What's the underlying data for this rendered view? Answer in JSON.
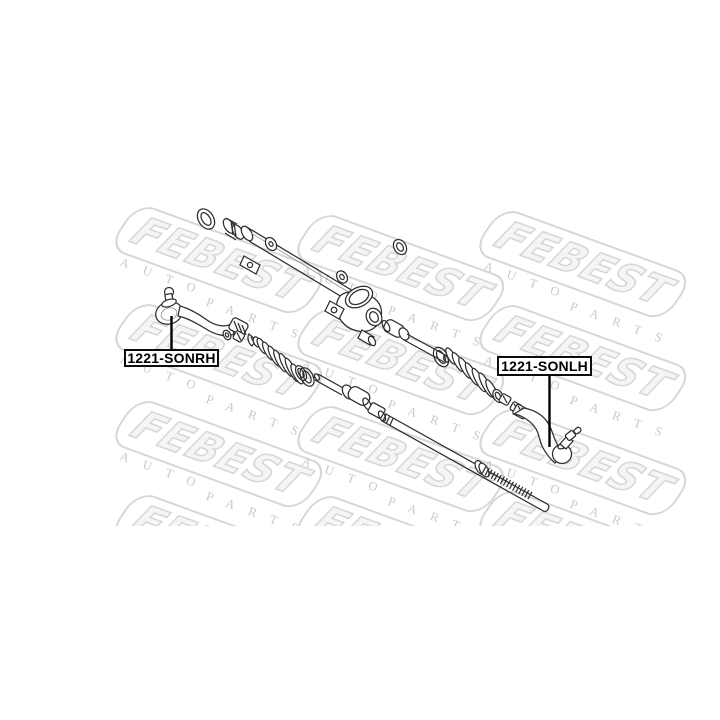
{
  "page": {
    "width": 720,
    "height": 720,
    "background": "#ffffff"
  },
  "theme": {
    "line_color": "#2e2e2e",
    "label_border_color": "#0d0d0d",
    "label_text_color": "#000000",
    "watermark_outline": "#d7d7d7",
    "watermark_fill": "#f5f5f5",
    "watermark_serif": "#c9c9c9",
    "page_bg": "#ffffff"
  },
  "watermark": {
    "brand": "FEBEST",
    "word_top": "AUTO",
    "word_bottom": "PARTS",
    "instances": [
      {
        "x": 138,
        "y": 6
      },
      {
        "x": 320,
        "y": 14
      },
      {
        "x": 502,
        "y": 10
      },
      {
        "x": 138,
        "y": 103
      },
      {
        "x": 320,
        "y": 108
      },
      {
        "x": 502,
        "y": 104
      },
      {
        "x": 138,
        "y": 200
      },
      {
        "x": 320,
        "y": 205
      },
      {
        "x": 502,
        "y": 208
      },
      {
        "x": 138,
        "y": 294
      },
      {
        "x": 320,
        "y": 295
      },
      {
        "x": 502,
        "y": 290
      }
    ]
  },
  "part_labels": [
    {
      "code": "1221-SONRH",
      "side": "left"
    },
    {
      "code": "1221-SONLH",
      "side": "right"
    }
  ],
  "diagram": {
    "type": "exploded-parts-drawing",
    "subject": "steering rack and tie rod assembly",
    "parts": [
      "snap-ring",
      "mount-bushing",
      "rack-housing-tube",
      "tube-clamp",
      "mount-bracket",
      "tube-boss-ring",
      "bushing-ring",
      "pinion-housing",
      "inner-tie-rod-right",
      "o-ring-right",
      "steering-boot-right",
      "boot-collar-right",
      "lock-nut-right",
      "tie-rod-end-right",
      "tie-rod-end-left",
      "washer-left",
      "lock-nut-left",
      "clip-left",
      "steering-boot-left",
      "boot-collar-left",
      "o-ring-left",
      "inner-tie-rod-left",
      "rack-bar"
    ]
  }
}
